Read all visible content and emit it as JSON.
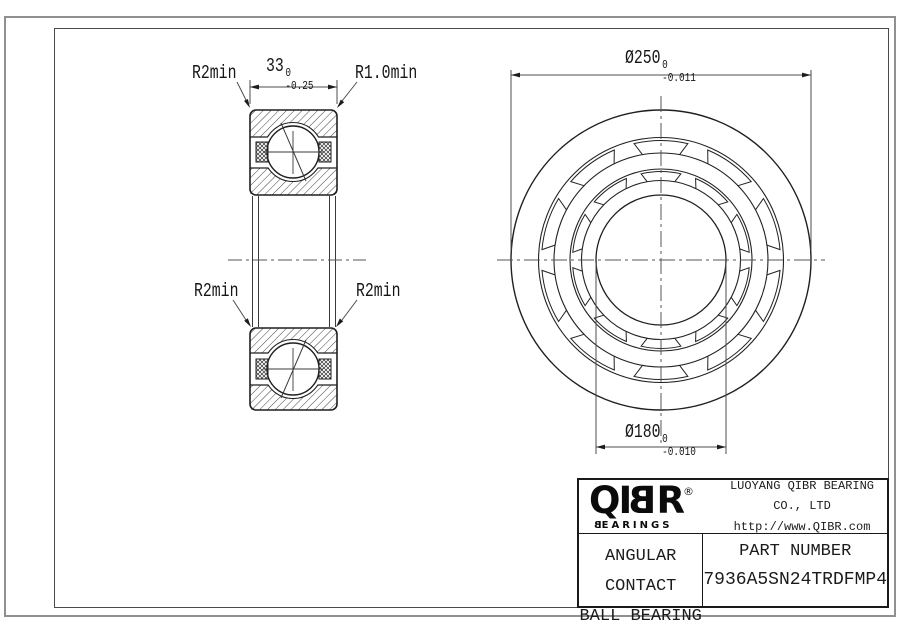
{
  "drawing": {
    "labels": {
      "r2min_top": "R2min",
      "r1min_top": "R1.0min",
      "r2min_mid_left": "R2min",
      "r2min_mid_right": "R2min"
    },
    "dims": {
      "width": {
        "value": "33",
        "tol_upper": "0",
        "tol_lower": "-0.25"
      },
      "outer_diameter": {
        "symbol": "Ø",
        "value": "250",
        "tol_upper": "0",
        "tol_lower": "-0.011"
      },
      "bore_diameter": {
        "symbol": "Ø",
        "value": "180",
        "tol_upper": "0",
        "tol_lower": "-0.010"
      }
    }
  },
  "title_block": {
    "logo": {
      "q": "Q",
      "i": "I",
      "b": "B",
      "r": "R",
      "registered": "®",
      "sub_b": "B",
      "sub_rest": "EARINGS"
    },
    "company": "LUOYANG QIBR BEARING CO., LTD",
    "website": "http://www.QIBR.com",
    "product_line1": "ANGULAR CONTACT",
    "product_line2": "BALL BEARING",
    "part_number_label": "PART NUMBER",
    "part_number": "7936A5SN24TRDFMP4"
  },
  "colors": {
    "line": "#1f1f1f",
    "thin_line": "#5a5a5a",
    "frame": "#4a4a4a",
    "page_border": "#909090",
    "background": "#ffffff"
  }
}
